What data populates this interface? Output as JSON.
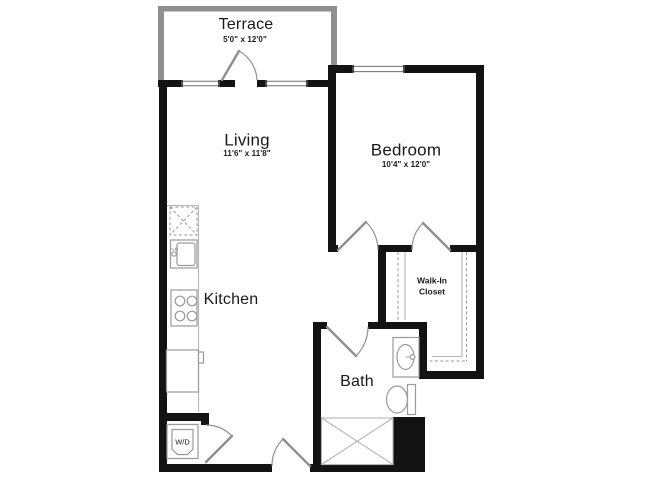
{
  "title": "One bedroom apartment floor plan",
  "labels": {
    "terrace": {
      "name": "Terrace",
      "dims": "5'0\" x 12'0\""
    },
    "living": {
      "name": "Living",
      "dims": "11'6\" x 11'8\""
    },
    "bedroom": {
      "name": "Bedroom",
      "dims": "10'4\" x 12'0\""
    },
    "kitchen": {
      "name": "Kitchen"
    },
    "walk_in_closet": {
      "line1": "Walk-In",
      "line2": "Closet"
    },
    "bath": {
      "name": "Bath"
    },
    "washer_dryer": {
      "name": "W/D"
    }
  },
  "colors": {
    "wall-color": "#131313",
    "terrace-wall-color": "#8f8f8f",
    "door-color": "#8f8f8f",
    "fixture-color": "#9a9a9a",
    "fixture-light-color": "#b5b5b5",
    "window-line-color": "#6e6e6e",
    "text-color": "#191919",
    "bg-color": "#ffffff"
  }
}
